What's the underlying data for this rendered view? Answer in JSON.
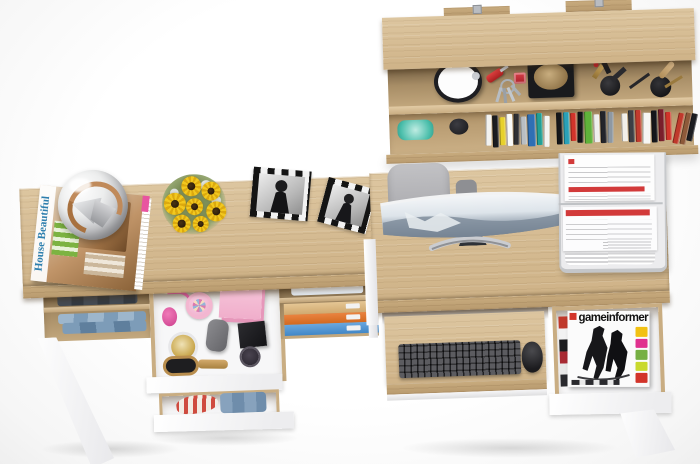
{
  "scene": {
    "description": "Top-down 3D product render of a light-oak home office set: wall shelf with books and trinkets, a vanity desk with open drawers of cosmetics and clothes, and a computer desk with curved monitor, keyboard tray and magazine drawer.",
    "background": "#ffffff"
  },
  "palette": {
    "oak": "#d5bd97",
    "oak_dark": "#b89a6e",
    "furniture_white": "#ffffff",
    "chair_gray": "#b3b3b6",
    "keyboard_black": "#3a3a3f",
    "screen_blue_gray": "#7c8a99",
    "accent_pink": "#f3b7d0",
    "accent_orange": "#e0762f",
    "accent_blue": "#5799d6",
    "paper_red": "#d23a3a",
    "glass_teal": "#45c0ae"
  },
  "wall_shelf": {
    "label": "wall shelf",
    "items": [
      "alarm-clock",
      "pocket-knife",
      "key-bunch",
      "hat-tray",
      "lipstick-set",
      "makeup-brush-set",
      "glass-ashtray",
      "book-row",
      "mounting-brackets"
    ],
    "book_colors": [
      "#f2f2f0",
      "#1b1c20",
      "#e8d12c",
      "#fafaf8",
      "#2f2f33",
      "#b9bec3",
      "#2f6fb4",
      "#22a096",
      "#f4f4f2",
      "#15161a",
      "#2aa1b8",
      "#d2342a",
      "#111216",
      "#5fb23a",
      "#efefed",
      "#23242a",
      "#8e98a2",
      "#f2efe9",
      "#3d3f45",
      "#c23b2e",
      "#f6f6f4",
      "#15161a",
      "#7a1f2b",
      "#d2342a",
      "#c0392b",
      "#8e5a3a",
      "#1b1c20"
    ]
  },
  "left_desk": {
    "label": "vanity desk",
    "magazine_title": "House Beautiful",
    "top_items": [
      "magazine-stack",
      "glass-dome-lamp",
      "sunflower-bouquet",
      "photo-frame",
      "photo-frame"
    ],
    "cosmetics_drawer_items": [
      "perfume-atomizer",
      "trinket-box",
      "pink-gift-box",
      "cream-jar",
      "makeup-pouch",
      "compact-case",
      "hairbrush"
    ],
    "clothes_drawer_items": [
      "striped-shirt",
      "folded-jeans"
    ],
    "cubby_items": [
      "folded-dark-clothes",
      "denim-stack",
      "white-cloth",
      "storage-boxes"
    ]
  },
  "right_desk": {
    "label": "computer desk",
    "magazine_title": "gameinformer",
    "items": [
      "office-chair",
      "curved-monitor",
      "document-tray",
      "keyboard",
      "mouse",
      "magazine-drawer"
    ],
    "magazine_edge_colors": [
      "#c0392b",
      "#f2f2f2",
      "#1d1d1f",
      "#a82a33",
      "#e8e8e8",
      "#2a2a2e"
    ],
    "cover_strip_colors": [
      "#f2c113",
      "#e0318e",
      "#76b043",
      "#c9d92e",
      "#d2342a"
    ]
  }
}
